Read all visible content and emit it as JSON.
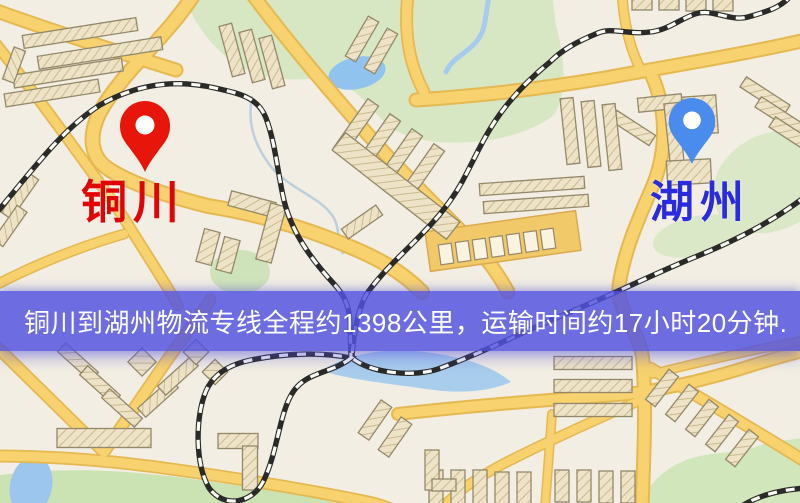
{
  "page": {
    "width_px": 800,
    "height_px": 503,
    "kind": "logistics-route-map-image"
  },
  "markers": {
    "origin": {
      "label": "铜川",
      "pin_color": "#e8150b",
      "label_color": "#e20404"
    },
    "destination": {
      "label": "湖州",
      "pin_color": "#4a8cee",
      "label_color": "#2a2ade"
    }
  },
  "banner": {
    "text": "铜川到湖州物流专线全程约1398公里，运输时间约17小时20分钟.",
    "background_color": "#5454e0",
    "text_color": "#ffffff",
    "distance_km": "1398",
    "duration": "17小时20分钟"
  },
  "map": {
    "style": "stylized street map",
    "background_color": "#f2eee3",
    "road_color": "#f7d26e",
    "park_color": "#d5e5bf",
    "water_color": "#9cc6ee",
    "building_color": "#eee3c6",
    "railway_style": "black-white dashed"
  }
}
